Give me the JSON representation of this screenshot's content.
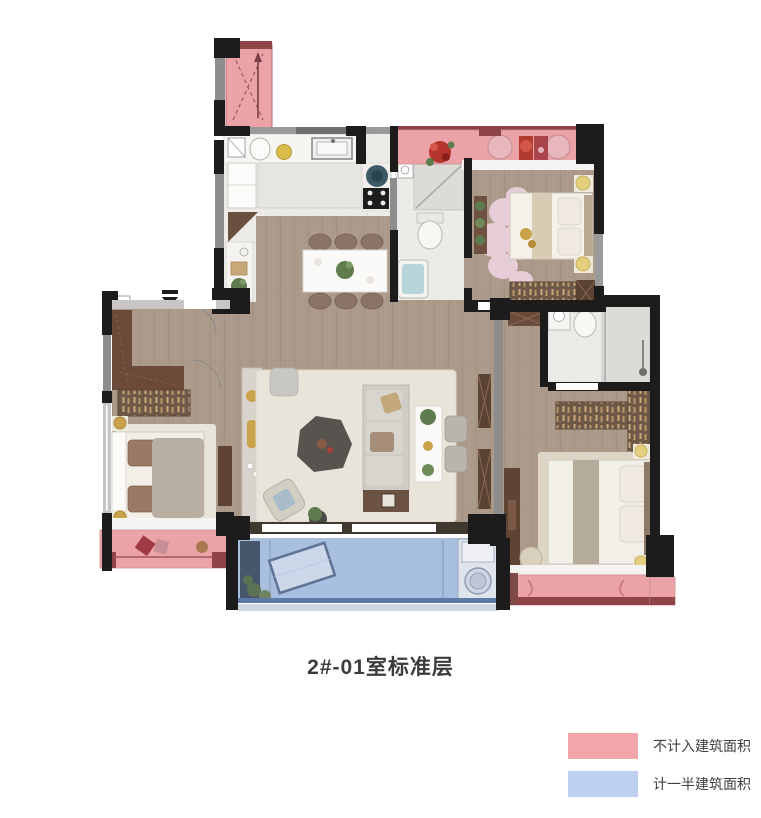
{
  "title": "2#-01室标准层",
  "legend": {
    "items": [
      {
        "label": "不计入建筑面积",
        "color": "#f2a6ac"
      },
      {
        "label": "计一半建筑面积",
        "color": "#bdd0f0"
      }
    ]
  },
  "colors": {
    "excluded_area_pink": "#eba3a8",
    "half_area_blue": "#a9bfdf",
    "wall_black": "#1c1c1c",
    "accent_dark_red": "#8e4449",
    "wood_floor": "#ab9a8a"
  }
}
